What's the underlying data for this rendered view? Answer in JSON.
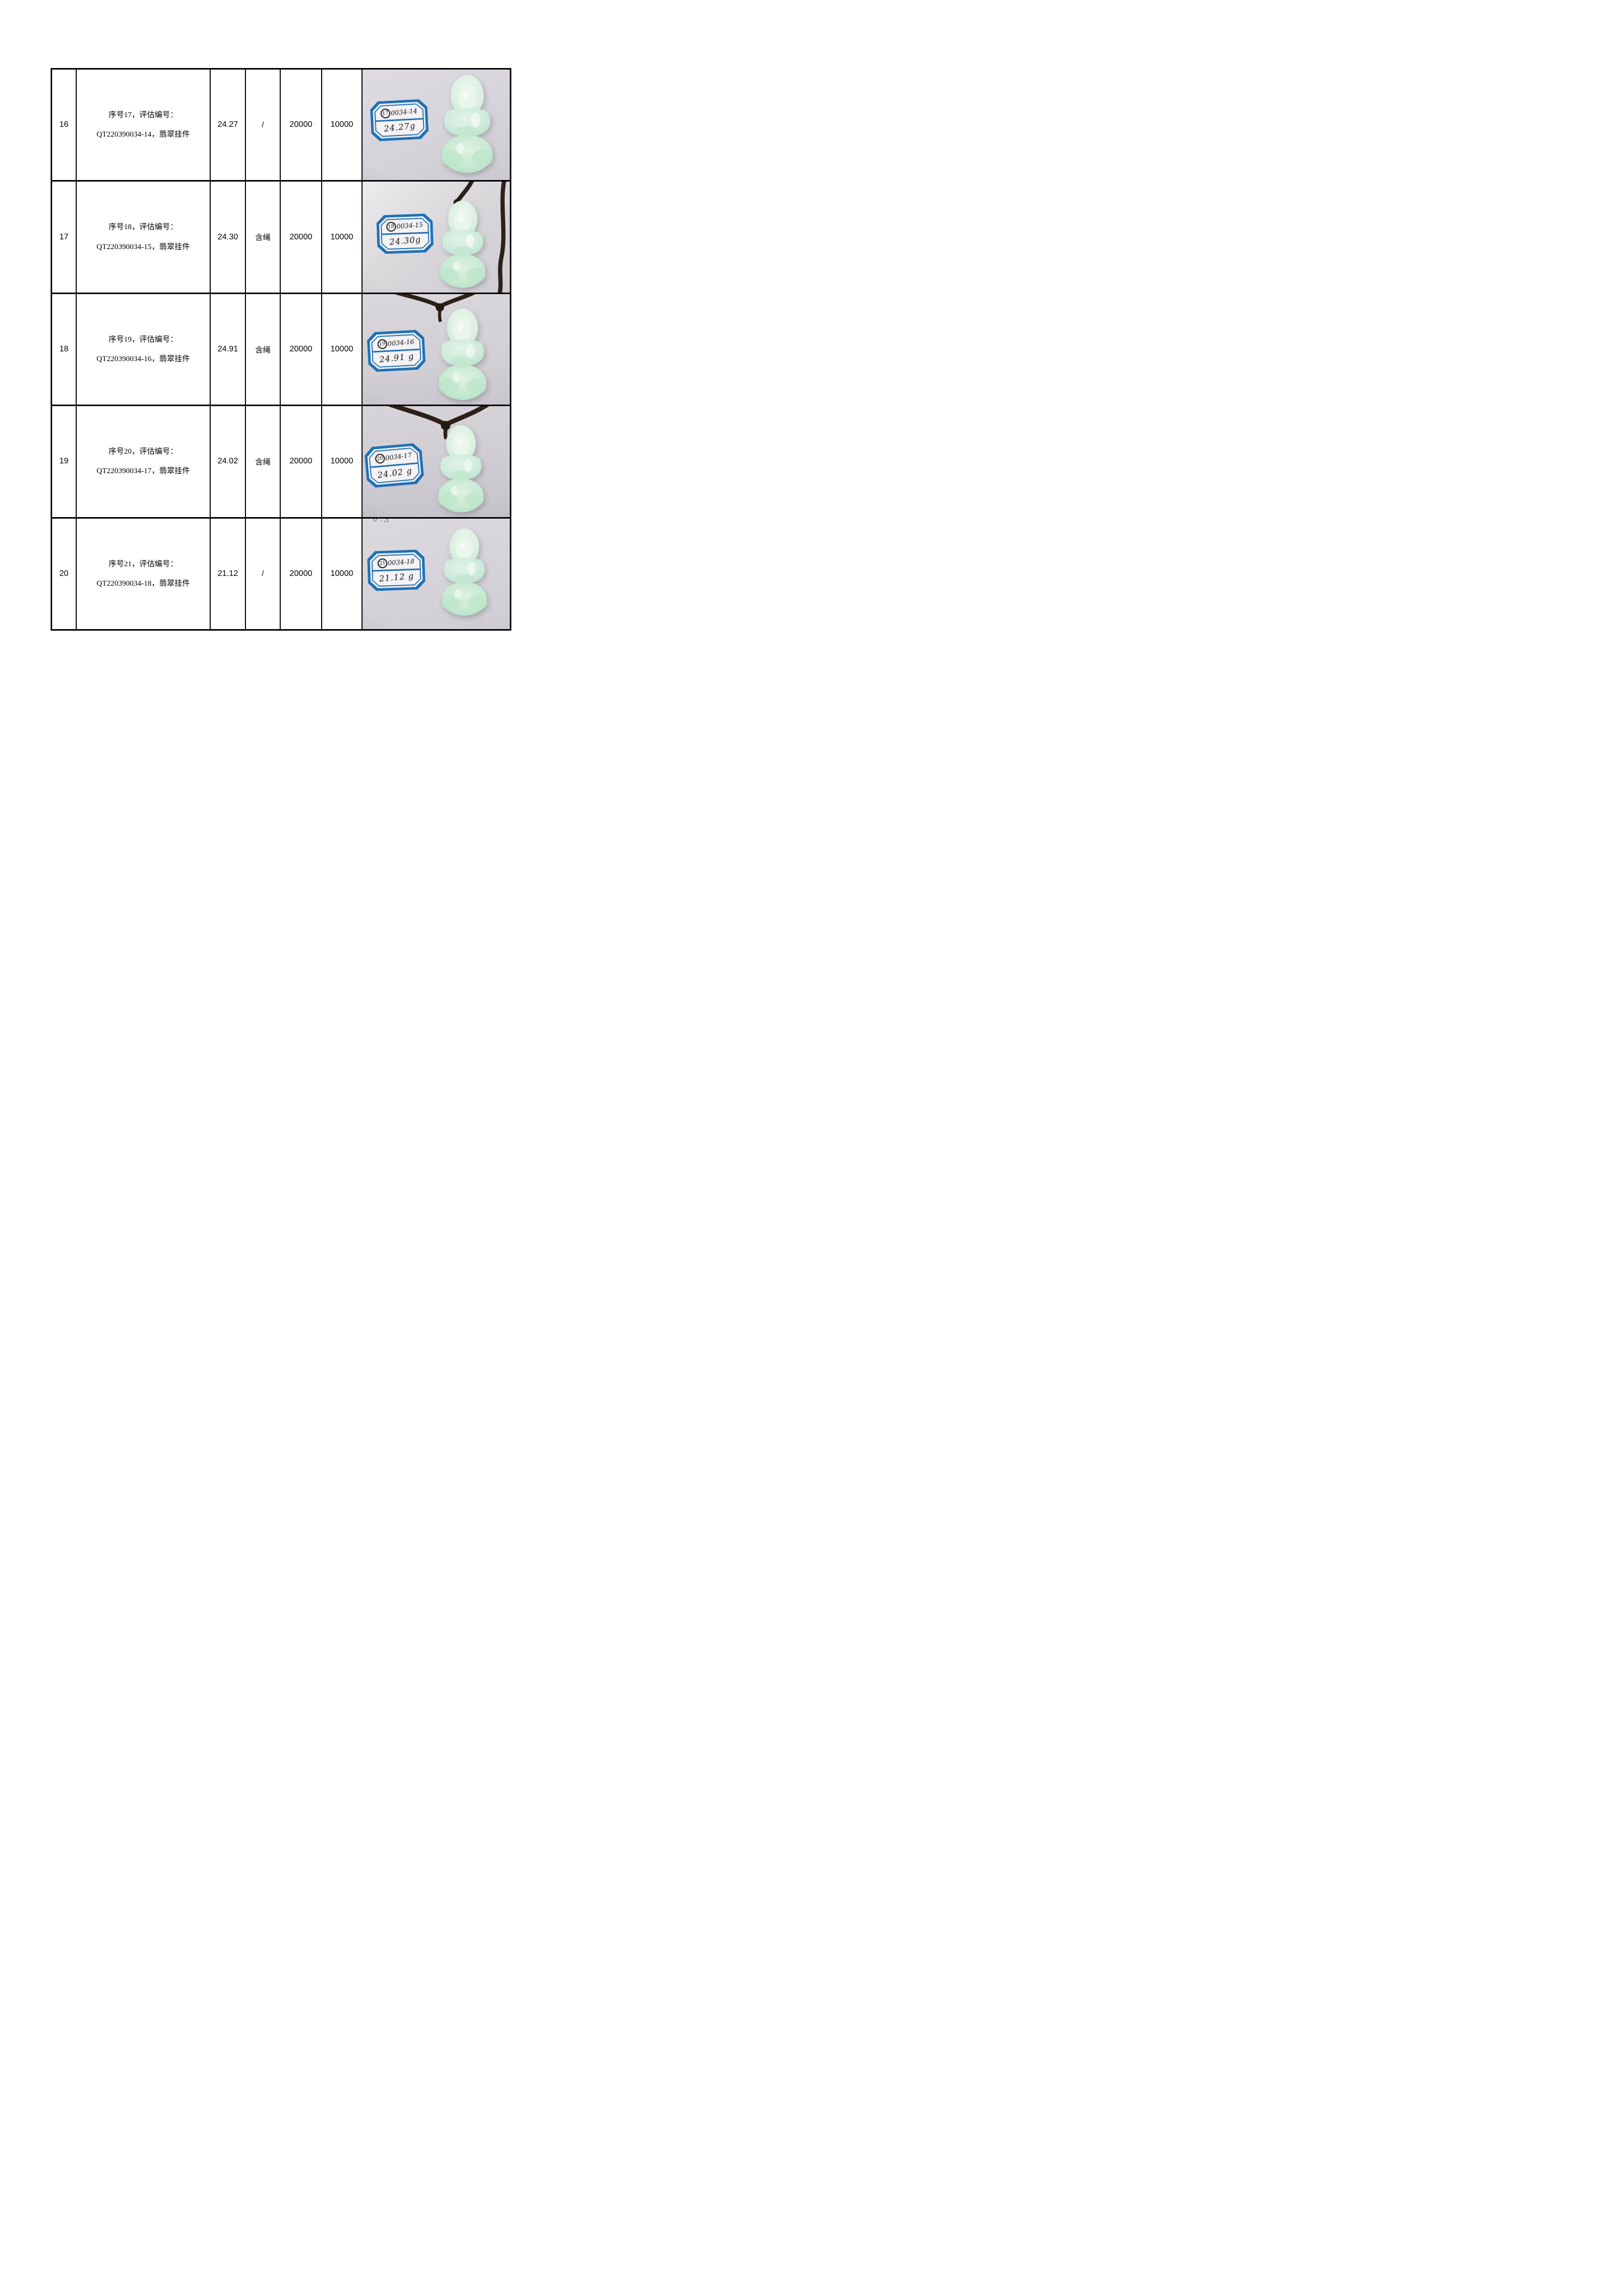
{
  "colors": {
    "tag_blue": "#2071b5",
    "jade_green_light": "#ddf0e2",
    "jade_green_mid": "#b9e2c6",
    "cord_brown": "#2d2019",
    "photo_background_gray": "#d6d3da",
    "table_border": "#000000"
  },
  "rows": [
    {
      "no": "16",
      "desc_line1": "序号17，评估编号：",
      "desc_line2": "QT220390034-14，翡翠挂件",
      "weight": "24.27",
      "rope": "/",
      "price_a": "20000",
      "price_b": "10000",
      "photo": {
        "label_circled": "17",
        "label_code": "0034-14",
        "label_weight": "24.27g",
        "has_cord": "false"
      }
    },
    {
      "no": "17",
      "desc_line1": "序号18，评估编号：",
      "desc_line2": "QT220390034-15，翡翠挂件",
      "weight": "24.30",
      "rope": "含绳",
      "price_a": "20000",
      "price_b": "10000",
      "photo": {
        "label_circled": "18",
        "label_code": "0034-15",
        "label_weight": "24.30g",
        "has_cord": "true"
      }
    },
    {
      "no": "18",
      "desc_line1": "序号19，评估编号：",
      "desc_line2": "QT220390034-16，翡翠挂件",
      "weight": "24.91",
      "rope": "含绳",
      "price_a": "20000",
      "price_b": "10000",
      "photo": {
        "label_circled": "19",
        "label_code": "0034-16",
        "label_weight": "24.91 g",
        "has_cord": "true"
      }
    },
    {
      "no": "19",
      "desc_line1": "序号20，评估编号：",
      "desc_line2": "QT220390034-17，翡翠挂件",
      "weight": "24.02",
      "rope": "含绳",
      "price_a": "20000",
      "price_b": "10000",
      "photo": {
        "label_circled": "20",
        "label_code": "0034-17",
        "label_weight": "24.02 g",
        "has_cord": "true"
      }
    },
    {
      "no": "20",
      "desc_line1": "序号21，评估编号：",
      "desc_line2": "QT220390034-18，翡翠挂件",
      "weight": "21.12",
      "rope": "/",
      "price_a": "20000",
      "price_b": "10000",
      "photo": {
        "label_circled": "21",
        "label_code": "0034-18",
        "label_weight": "21.12 g",
        "has_cord": "false",
        "faint_mark": "0.3"
      }
    }
  ]
}
